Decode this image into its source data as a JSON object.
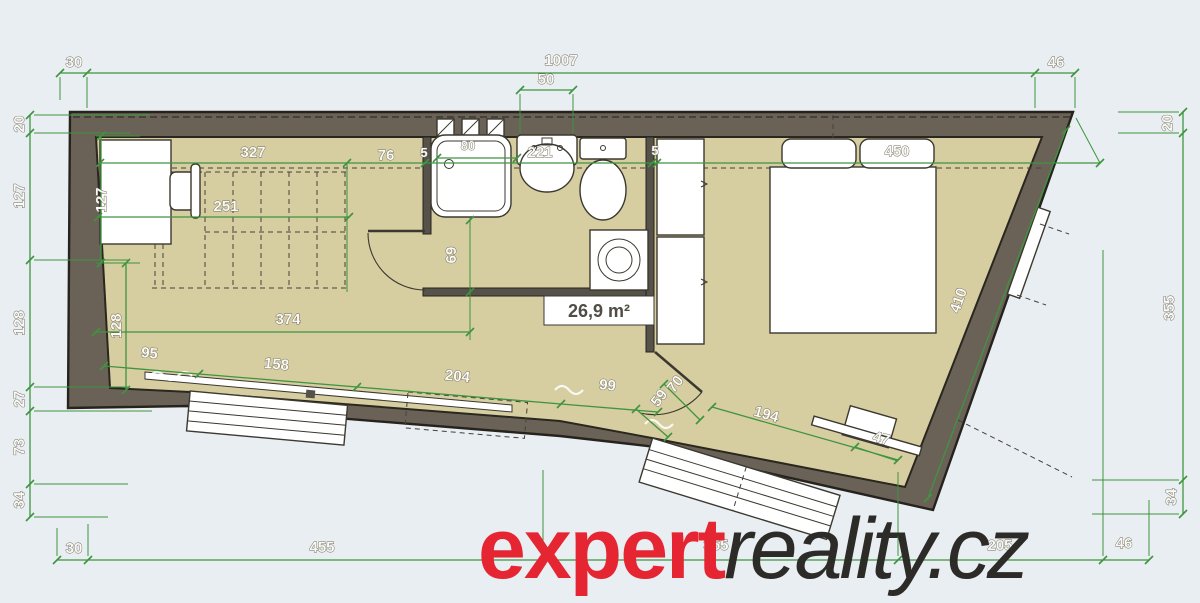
{
  "watermark": {
    "red_text": "expert",
    "dark_text": "reality.cz"
  },
  "area_label": "26,9 m²",
  "colors": {
    "background": "#e8eef1",
    "wall": "#6b6257",
    "floor": "#d6cda0",
    "dimension_green": "#3f9440",
    "watermark_red": "#e52531",
    "watermark_dark": "#2d2b28"
  },
  "dims": {
    "top": [
      "30",
      "1007",
      "46"
    ],
    "skylight": "50",
    "left": [
      "20",
      "127",
      "128",
      "27",
      "73",
      "34"
    ],
    "right": [
      "20",
      "355",
      "34"
    ],
    "bottom": [
      "30",
      "455",
      "355",
      "205",
      "46"
    ],
    "interior": {
      "room_top": "327",
      "stair_len": "251",
      "stair_to_wall": "76",
      "wall_thin_left": "5",
      "bath_width": "221",
      "wall_thin_right": "5",
      "bed_wall": "450",
      "tub": "80",
      "desk_side": "127",
      "left_lower": "128",
      "hall_width": "374",
      "hall_height": "69",
      "floor1": "95",
      "floor2": "158",
      "floor3": "204",
      "floor4": "99",
      "door_w1": "59",
      "door_w2": "70",
      "wall_diag": "410",
      "entry_wall": "194",
      "corner": "47"
    }
  }
}
